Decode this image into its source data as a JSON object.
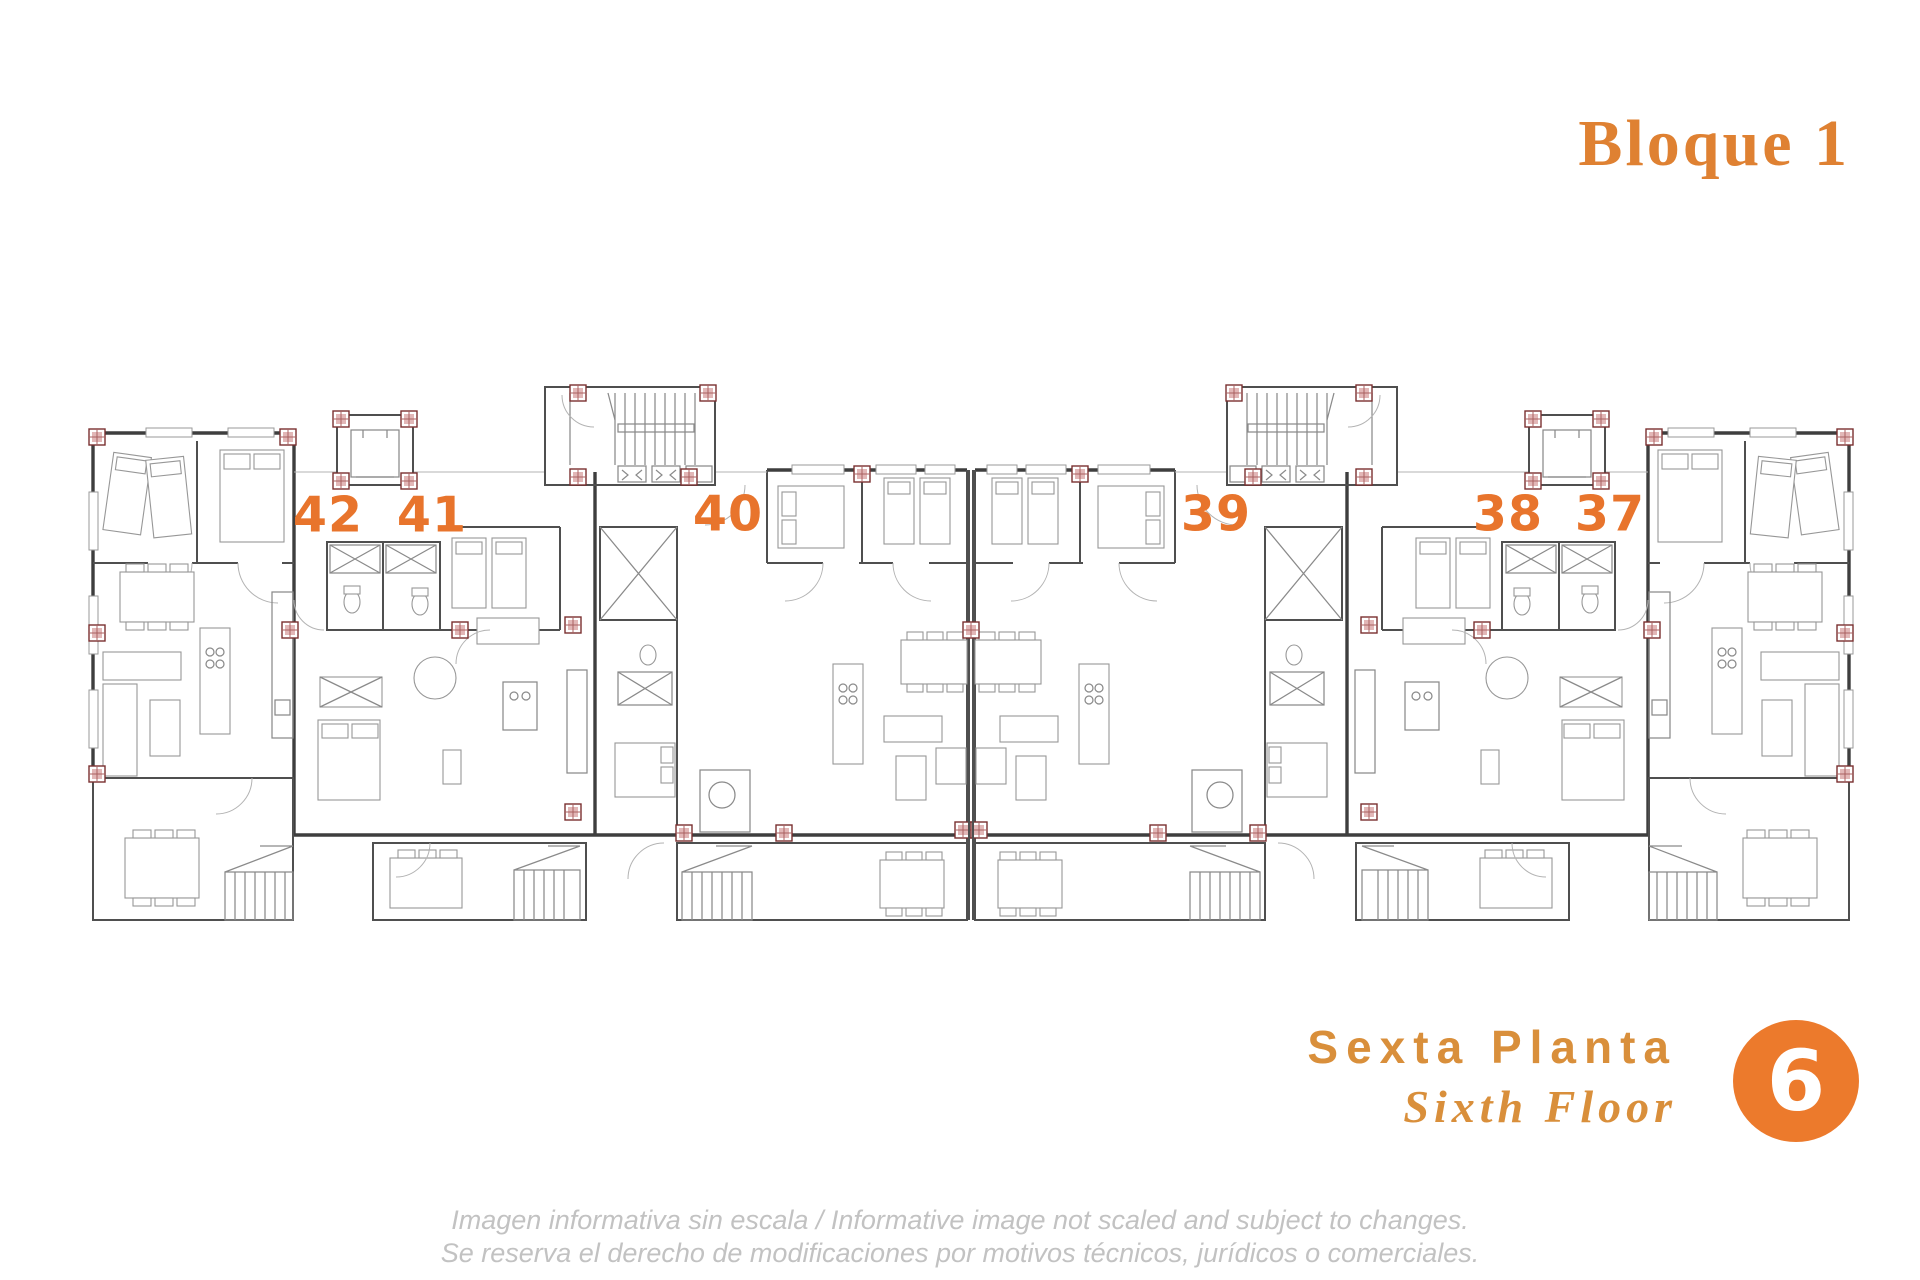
{
  "title": {
    "text": "Bloque 1"
  },
  "plan": {
    "units": [
      {
        "number": "42"
      },
      {
        "number": "41"
      },
      {
        "number": "40"
      },
      {
        "number": "39"
      },
      {
        "number": "38"
      },
      {
        "number": "37"
      }
    ]
  },
  "floor": {
    "name_es": "Sexta Planta",
    "name_en": "Sixth Floor",
    "badge": "6"
  },
  "disclaimer": {
    "line1": "Imagen informativa sin escala /  Informative image not scaled and subject to changes.",
    "line2": "Se reserva el derecho de modificaciones por motivos técnicos, jurídicos o comerciales."
  },
  "colors": {
    "unit_number_orange": "#E8742C",
    "heading_orange": "#DF8132",
    "floor_text_orange": "#D98F3B",
    "badge_orange": "#EC7A2C",
    "wall_gray": "#3e3e3e",
    "furniture_gray": "#979797",
    "column_red": "#7a3030",
    "disclaimer_gray": "#C2C2C2"
  }
}
